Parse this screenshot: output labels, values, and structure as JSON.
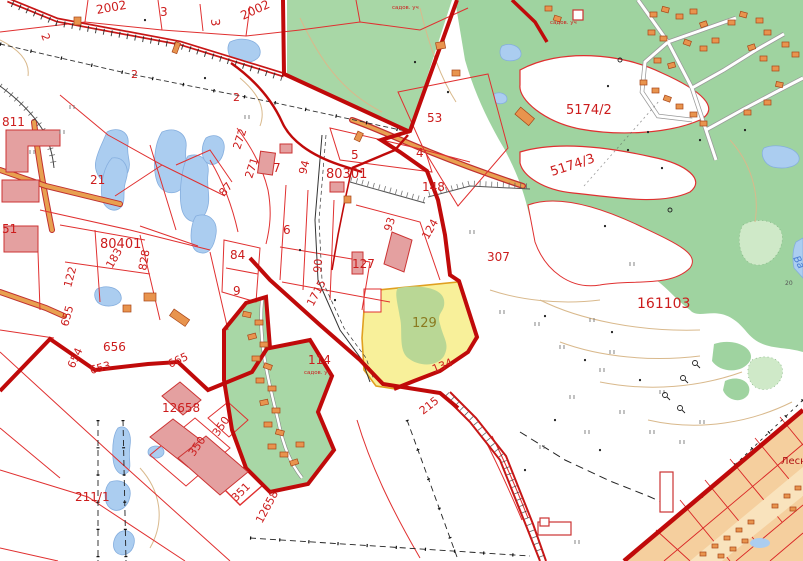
{
  "map": {
    "type": "cadastral-topographic-map",
    "colors": {
      "label_red": "#cc1c1c",
      "label_olive": "#8a7a20",
      "label_darkred": "#b01212",
      "label_blue": "#4a7fd4",
      "label_gray": "#555555",
      "boundary_red": "#c00a0a",
      "parcel_red": "#e03030",
      "forest_green": "#9fd3a0",
      "garden_green": "#a8d7a6",
      "light_green": "#cfe9c8",
      "lake_blue": "#abcdf0",
      "selected_yellow": "#f8f09a",
      "selected_border": "#e0a020",
      "building_pink": "#e4a0a0",
      "house_orange": "#e8944e",
      "residential_tan": "#f5cf9e",
      "road_orange": "#e8a050",
      "contour_tan": "#d9b98c"
    },
    "labels": [
      {
        "text": "2002",
        "x": 97,
        "y": 14,
        "rot": -10,
        "fs": 12,
        "c": "red"
      },
      {
        "text": "3",
        "x": 160,
        "y": 16,
        "rot": 0,
        "fs": 12,
        "c": "red"
      },
      {
        "text": "3",
        "x": 211,
        "y": 19,
        "rot": 85,
        "fs": 12,
        "c": "red"
      },
      {
        "text": "2002",
        "x": 243,
        "y": 20,
        "rot": -25,
        "fs": 12,
        "c": "red"
      },
      {
        "text": "2",
        "x": 41,
        "y": 35,
        "rot": 70,
        "fs": 11,
        "c": "red"
      },
      {
        "text": "2",
        "x": 131,
        "y": 78,
        "rot": 0,
        "fs": 11,
        "c": "red"
      },
      {
        "text": "2",
        "x": 233,
        "y": 101,
        "rot": 0,
        "fs": 11,
        "c": "red"
      },
      {
        "text": "811",
        "x": 2,
        "y": 126,
        "rot": 0,
        "fs": 12,
        "c": "red"
      },
      {
        "text": "21",
        "x": 90,
        "y": 184,
        "rot": 0,
        "fs": 12,
        "c": "red"
      },
      {
        "text": "272",
        "x": 240,
        "y": 150,
        "rot": -72,
        "fs": 11,
        "c": "red"
      },
      {
        "text": "271",
        "x": 252,
        "y": 179,
        "rot": -72,
        "fs": 11,
        "c": "red"
      },
      {
        "text": "87",
        "x": 224,
        "y": 197,
        "rot": -50,
        "fs": 11,
        "c": "red"
      },
      {
        "text": "51",
        "x": 2,
        "y": 233,
        "rot": 0,
        "fs": 12,
        "c": "red"
      },
      {
        "text": "80401",
        "x": 100,
        "y": 248,
        "rot": 0,
        "fs": 13,
        "c": "red"
      },
      {
        "text": "183",
        "x": 112,
        "y": 269,
        "rot": -60,
        "fs": 11,
        "c": "red"
      },
      {
        "text": "828",
        "x": 146,
        "y": 271,
        "rot": -80,
        "fs": 11,
        "c": "red"
      },
      {
        "text": "122",
        "x": 71,
        "y": 288,
        "rot": -75,
        "fs": 11,
        "c": "red"
      },
      {
        "text": "84",
        "x": 230,
        "y": 259,
        "rot": 0,
        "fs": 12,
        "c": "red"
      },
      {
        "text": "9",
        "x": 233,
        "y": 295,
        "rot": 0,
        "fs": 12,
        "c": "red"
      },
      {
        "text": "7",
        "x": 273,
        "y": 172,
        "rot": 0,
        "fs": 12,
        "c": "red"
      },
      {
        "text": "94",
        "x": 306,
        "y": 175,
        "rot": -75,
        "fs": 11,
        "c": "red"
      },
      {
        "text": "80301",
        "x": 326,
        "y": 178,
        "rot": 0,
        "fs": 13,
        "c": "red"
      },
      {
        "text": "5",
        "x": 351,
        "y": 159,
        "rot": 0,
        "fs": 12,
        "c": "red"
      },
      {
        "text": "4",
        "x": 416,
        "y": 157,
        "rot": 0,
        "fs": 12,
        "c": "red"
      },
      {
        "text": "53",
        "x": 427,
        "y": 122,
        "rot": 0,
        "fs": 12,
        "c": "red"
      },
      {
        "text": "148",
        "x": 422,
        "y": 191,
        "rot": 0,
        "fs": 12,
        "c": "red"
      },
      {
        "text": "6",
        "x": 283,
        "y": 234,
        "rot": 0,
        "fs": 12,
        "c": "red"
      },
      {
        "text": "93",
        "x": 391,
        "y": 232,
        "rot": -72,
        "fs": 11,
        "c": "red"
      },
      {
        "text": "124",
        "x": 428,
        "y": 240,
        "rot": -60,
        "fs": 11,
        "c": "red"
      },
      {
        "text": "127",
        "x": 352,
        "y": 268,
        "rot": 0,
        "fs": 12,
        "c": "red"
      },
      {
        "text": "90",
        "x": 321,
        "y": 273,
        "rot": -85,
        "fs": 11,
        "c": "red"
      },
      {
        "text": "307",
        "x": 487,
        "y": 261,
        "rot": 0,
        "fs": 12,
        "c": "red"
      },
      {
        "text": "5174/2",
        "x": 566,
        "y": 114,
        "rot": 0,
        "fs": 13,
        "c": "red"
      },
      {
        "text": "5174/3",
        "x": 552,
        "y": 176,
        "rot": -18,
        "fs": 13,
        "c": "red"
      },
      {
        "text": "161103",
        "x": 637,
        "y": 308,
        "rot": 0,
        "fs": 14,
        "c": "red"
      },
      {
        "text": "129",
        "x": 412,
        "y": 327,
        "rot": 0,
        "fs": 13,
        "c": "olive"
      },
      {
        "text": "1715",
        "x": 313,
        "y": 307,
        "rot": -62,
        "fs": 11,
        "c": "red"
      },
      {
        "text": "114",
        "x": 308,
        "y": 364,
        "rot": 0,
        "fs": 12,
        "c": "red"
      },
      {
        "text": "134",
        "x": 434,
        "y": 373,
        "rot": -22,
        "fs": 11,
        "c": "red"
      },
      {
        "text": "215",
        "x": 423,
        "y": 415,
        "rot": -38,
        "fs": 11,
        "c": "red"
      },
      {
        "text": "655",
        "x": 68,
        "y": 327,
        "rot": -75,
        "fs": 11,
        "c": "red"
      },
      {
        "text": "656",
        "x": 103,
        "y": 351,
        "rot": 0,
        "fs": 12,
        "c": "red"
      },
      {
        "text": "654",
        "x": 74,
        "y": 369,
        "rot": -65,
        "fs": 11,
        "c": "red"
      },
      {
        "text": "653",
        "x": 91,
        "y": 374,
        "rot": -15,
        "fs": 11,
        "c": "red"
      },
      {
        "text": "665",
        "x": 170,
        "y": 368,
        "rot": -25,
        "fs": 11,
        "c": "red"
      },
      {
        "text": "12658",
        "x": 162,
        "y": 412,
        "rot": 0,
        "fs": 12,
        "c": "red"
      },
      {
        "text": "12658",
        "x": 262,
        "y": 524,
        "rot": -62,
        "fs": 11,
        "c": "red"
      },
      {
        "text": "211/1",
        "x": 75,
        "y": 501,
        "rot": 0,
        "fs": 12,
        "c": "red"
      },
      {
        "text": "350",
        "x": 194,
        "y": 457,
        "rot": -55,
        "fs": 11,
        "c": "red"
      },
      {
        "text": "350",
        "x": 218,
        "y": 437,
        "rot": -55,
        "fs": 11,
        "c": "red"
      },
      {
        "text": "351",
        "x": 236,
        "y": 502,
        "rot": -45,
        "fs": 11,
        "c": "red"
      }
    ],
    "small_texts": [
      {
        "text": "садов. уч",
        "x": 392,
        "y": 9,
        "rot": 0,
        "fs": 5.5,
        "c": "red"
      },
      {
        "text": "садов. уч",
        "x": 550,
        "y": 24,
        "rot": 0,
        "fs": 5.5,
        "c": "red"
      },
      {
        "text": "садов. уч",
        "x": 304,
        "y": 374,
        "rot": 0,
        "fs": 5.5,
        "c": "red"
      },
      {
        "text": "Лесн",
        "x": 781,
        "y": 464,
        "rot": 0,
        "fs": 10,
        "c": "darkred"
      },
      {
        "text": "Ва",
        "x": 793,
        "y": 258,
        "rot": 62,
        "fs": 10,
        "c": "blue",
        "italic": true
      },
      {
        "text": "20",
        "x": 785,
        "y": 285,
        "rot": 0,
        "fs": 6,
        "c": "gray"
      }
    ]
  }
}
